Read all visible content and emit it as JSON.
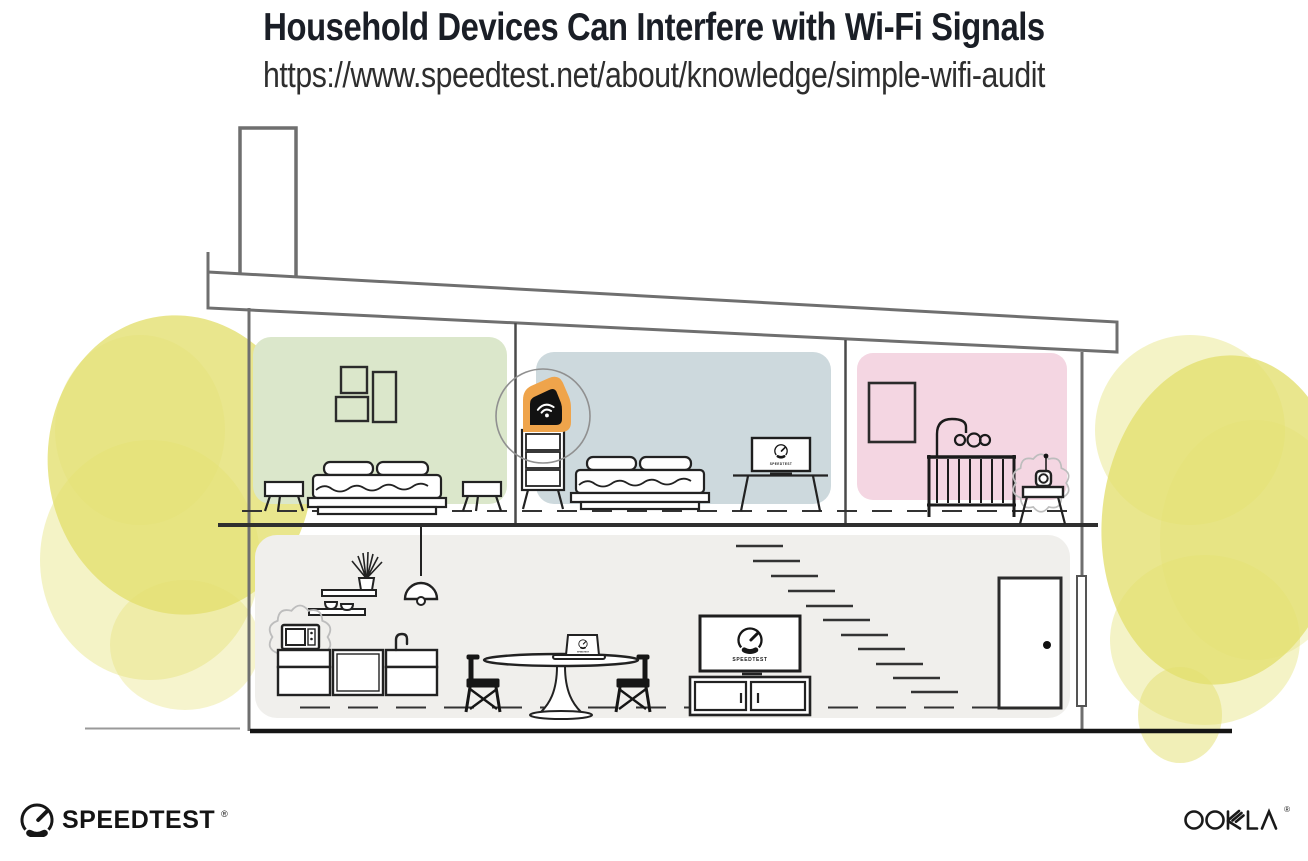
{
  "header": {
    "title": "Household Devices Can Interfere with Wi-Fi Signals",
    "url": "https://www.speedtest.net/about/knowledge/simple-wifi-audit"
  },
  "screens": {
    "label": "SPEEDTEST"
  },
  "branding": {
    "speedtest_wordmark": "SPEEDTEST",
    "speedtest_trademark": "®",
    "ookla_wordmark": "OOKLA",
    "ookla_trademark": "®"
  },
  "illustration": {
    "scene": "two-story house cross-section",
    "upper_rooms": [
      "bedroom-green",
      "bedroom-blue",
      "nursery-pink"
    ],
    "lower_areas": [
      "kitchen",
      "dining-area",
      "living-room",
      "stairs",
      "front-door"
    ],
    "devices": [
      "wifi-router",
      "bedroom-tv-speedtest",
      "living-room-tv-speedtest",
      "dining-laptop-speedtest",
      "microwave",
      "baby-monitor"
    ],
    "interference_sources": [
      "microwave",
      "baby-monitor"
    ]
  },
  "colors": {
    "title_text": "#1a1e26",
    "url_text": "#2e2e2e",
    "room_green": "#dbe7cb",
    "room_blue": "#cdd9dd",
    "room_pink": "#f4d6e2",
    "lower_floor": "#f0efec",
    "tree_yellow": "#e4e070",
    "router_orange": "#efa44b",
    "outline_dark": "#2b2b2b",
    "wall_gray": "#6f6f6f",
    "logo_black": "#141414"
  }
}
